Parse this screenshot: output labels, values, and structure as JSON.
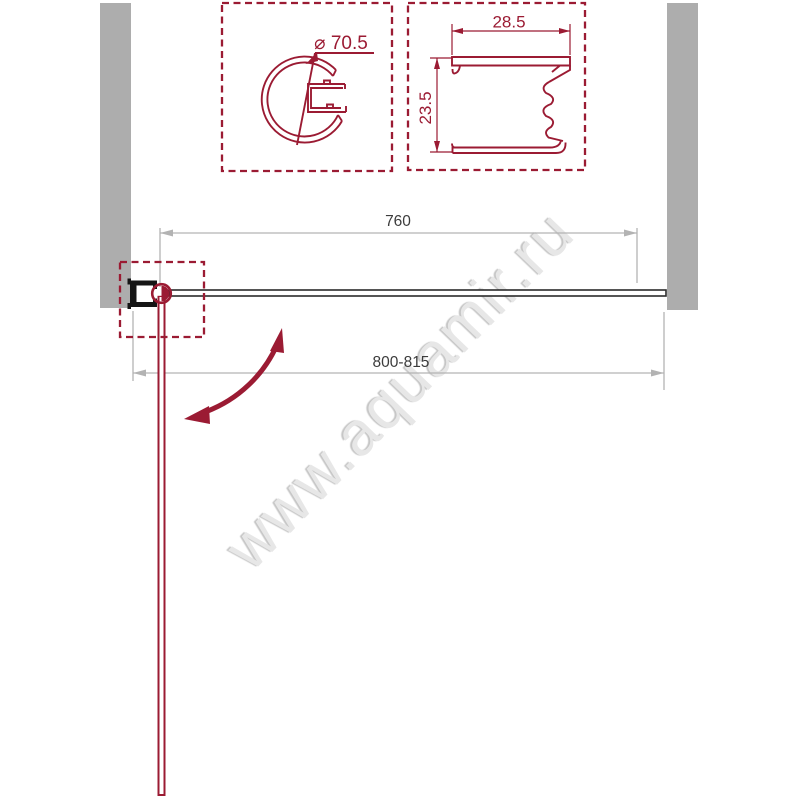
{
  "watermark": {
    "text": "www.aquamir.ru"
  },
  "detail_circle_profile": {
    "diameter_label": "⌀ 70.5"
  },
  "detail_wall_profile": {
    "width_label": "28.5",
    "height_label": "23.5"
  },
  "plan": {
    "glass_width_label": "760",
    "opening_width_label": "800-815"
  },
  "colors": {
    "profile_red": "#9b1b33",
    "wall_gray": "#adadad",
    "dim_gray": "#b3b3b3",
    "dim_text": "#3c3c3c",
    "glass_stroke": "#2b2b2b",
    "watermark_gray": "#e7e7e7"
  }
}
